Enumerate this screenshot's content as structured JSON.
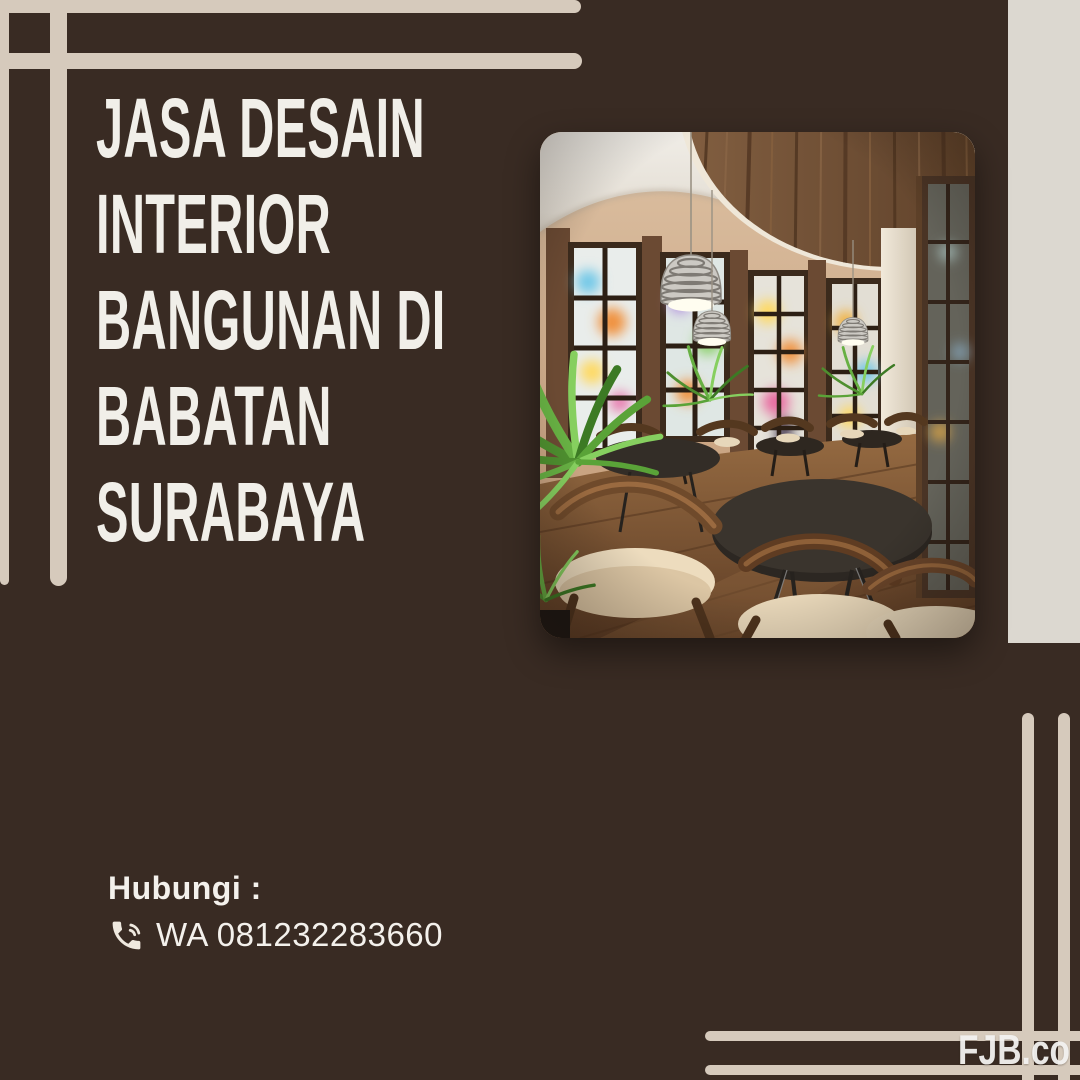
{
  "poster": {
    "background_color": "#392b23",
    "accent_line_color": "#d6cabc",
    "side_panel_color": "#dcd8d0"
  },
  "headline": {
    "lines": [
      "JASA DESAIN",
      "INTERIOR",
      "BANGUNAN DI",
      "BABATAN",
      "SURABAYA"
    ],
    "text_color": "#f1efe9"
  },
  "photo": {
    "subject": "cafe-interior-3d-render",
    "alt": "Cafe interior with curved window wall, round dark tables, wooden chairs with cream cushions, green plants and wire pendant lamps"
  },
  "contact": {
    "heading": "Hubungi :",
    "icon": "phone-in-talk-icon",
    "phone_line": "WA 081232283660"
  },
  "watermark": {
    "text": "FJB.co"
  }
}
